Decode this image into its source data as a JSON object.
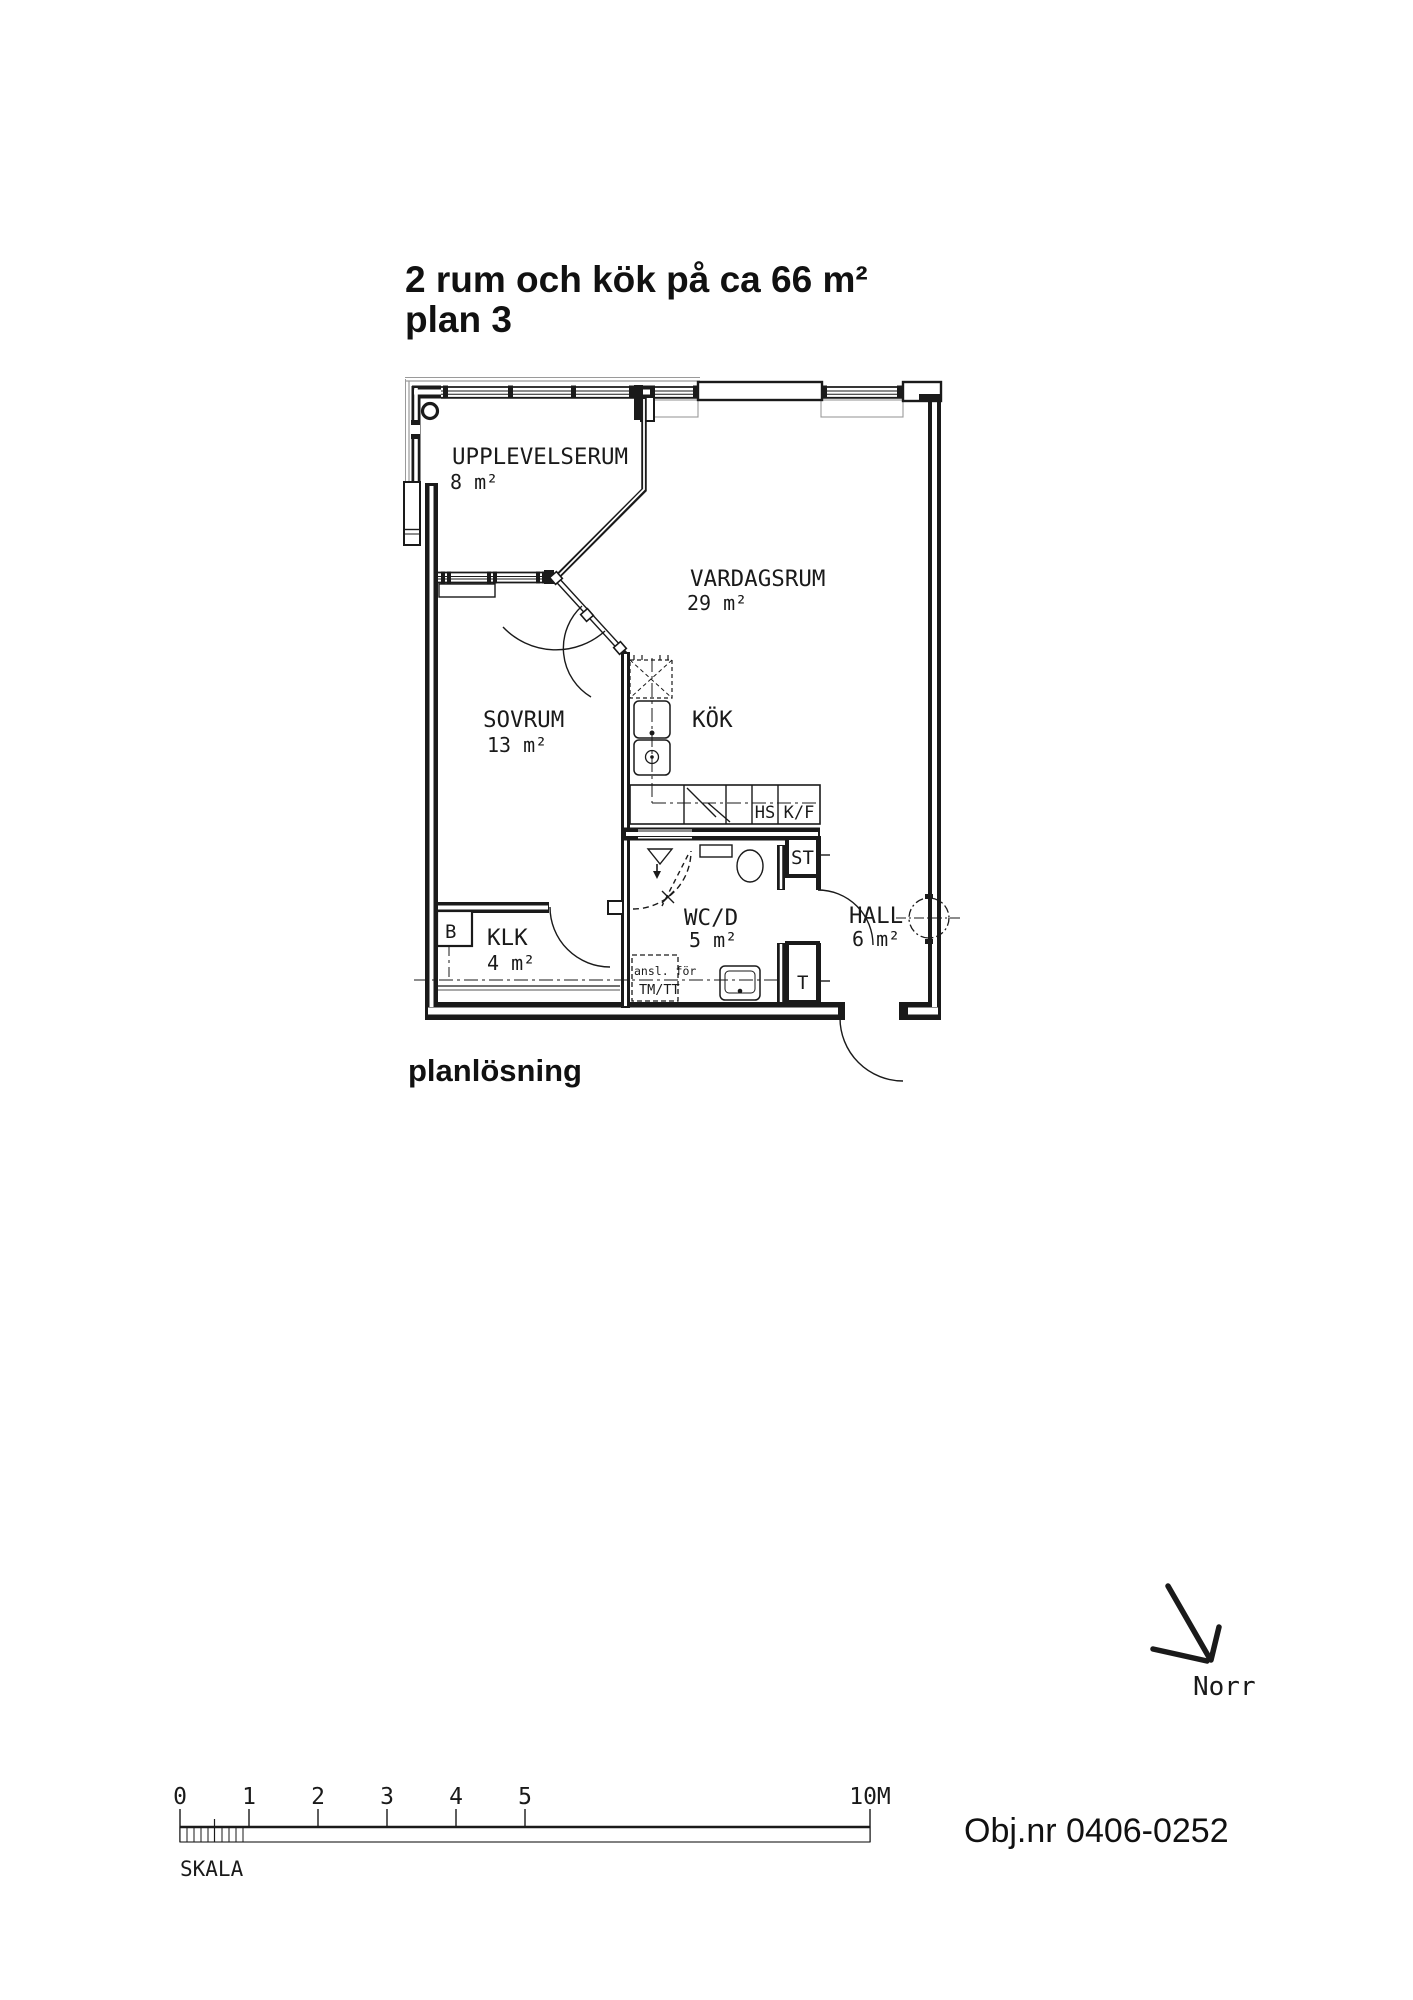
{
  "title": {
    "line1": "2 rum och kök på ca 66 m²",
    "line2": "plan 3"
  },
  "caption": "planlösning",
  "rooms": {
    "upplevelserum": {
      "name": "UPPLEVELSERUM",
      "area": "8 m²"
    },
    "vardagsrum": {
      "name": "VARDAGSRUM",
      "area": "29 m²"
    },
    "sovrum": {
      "name": "SOVRUM",
      "area": "13 m²"
    },
    "kok": {
      "name": "KÖK"
    },
    "wcd": {
      "name": "WC/D",
      "area": "5 m²"
    },
    "hall": {
      "name": "HALL",
      "area": "6 m²"
    },
    "klk": {
      "name": "KLK",
      "area": "4 m²"
    }
  },
  "labels": {
    "hs": "HS",
    "kf": "K/F",
    "st": "ST",
    "t": "T",
    "b": "B",
    "tm_line1": "ansl. för",
    "tm_line2": "TM/TT"
  },
  "north": {
    "label": "Norr"
  },
  "scalebar": {
    "title": "SKALA",
    "ticks": [
      "0",
      "1",
      "2",
      "3",
      "4",
      "5"
    ],
    "end_label": "10M"
  },
  "footer": {
    "object_number": "Obj.nr 0406-0252"
  },
  "colors": {
    "ink": "#1a1a1a",
    "gray": "#9a9a9a",
    "paper": "#ffffff"
  }
}
